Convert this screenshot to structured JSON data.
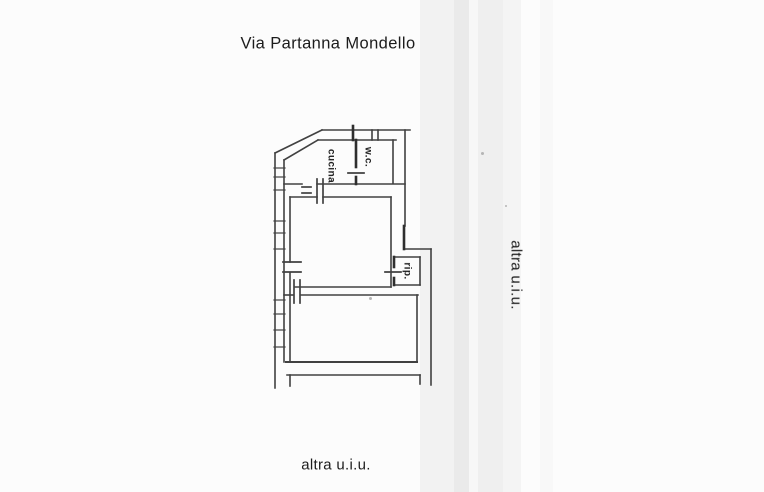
{
  "document": {
    "street_label": "Via Partanna Mondello",
    "adjacent_unit_right": "altra u.i.u.",
    "adjacent_unit_bottom": "altra u.i.u."
  },
  "floorplan": {
    "room_labels": [
      {
        "id": "cucina",
        "label": "cucina"
      },
      {
        "id": "wc",
        "label": "w.c."
      },
      {
        "id": "rip",
        "label": "rip."
      }
    ]
  },
  "colors": {
    "ink": "#414141",
    "ink-dark": "#2e2e2e",
    "text": "#1c1c1c",
    "paper": "#fcfcfc"
  }
}
